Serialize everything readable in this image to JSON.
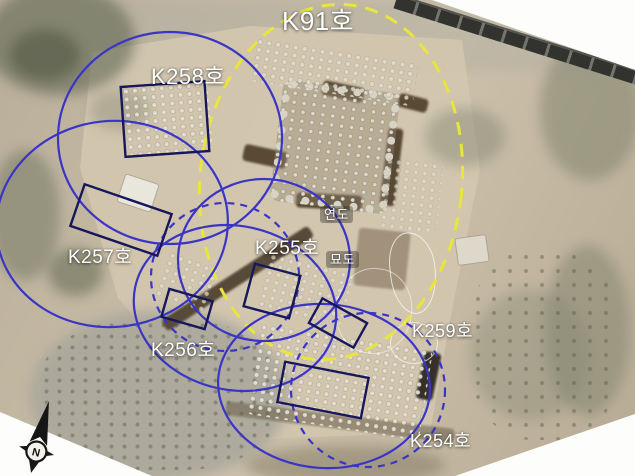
{
  "figure": {
    "site_label": "K91호",
    "tomb_labels": {
      "k258": "K258호",
      "k257": "K257호",
      "k255": "K255호",
      "k256": "K256호",
      "k259": "K259호",
      "k254": "K254호"
    },
    "feature_labels": {
      "flue": "연도",
      "passage": "묘도"
    },
    "compass": {
      "icon": "north-arrow-icon",
      "letter": "N"
    },
    "colors": {
      "site_outline_yellow": "#e8e63c",
      "tomb_circle_blue": "#3b35c5",
      "feature_rect_navy": "#17175a",
      "label_text": "#ffffff"
    }
  }
}
